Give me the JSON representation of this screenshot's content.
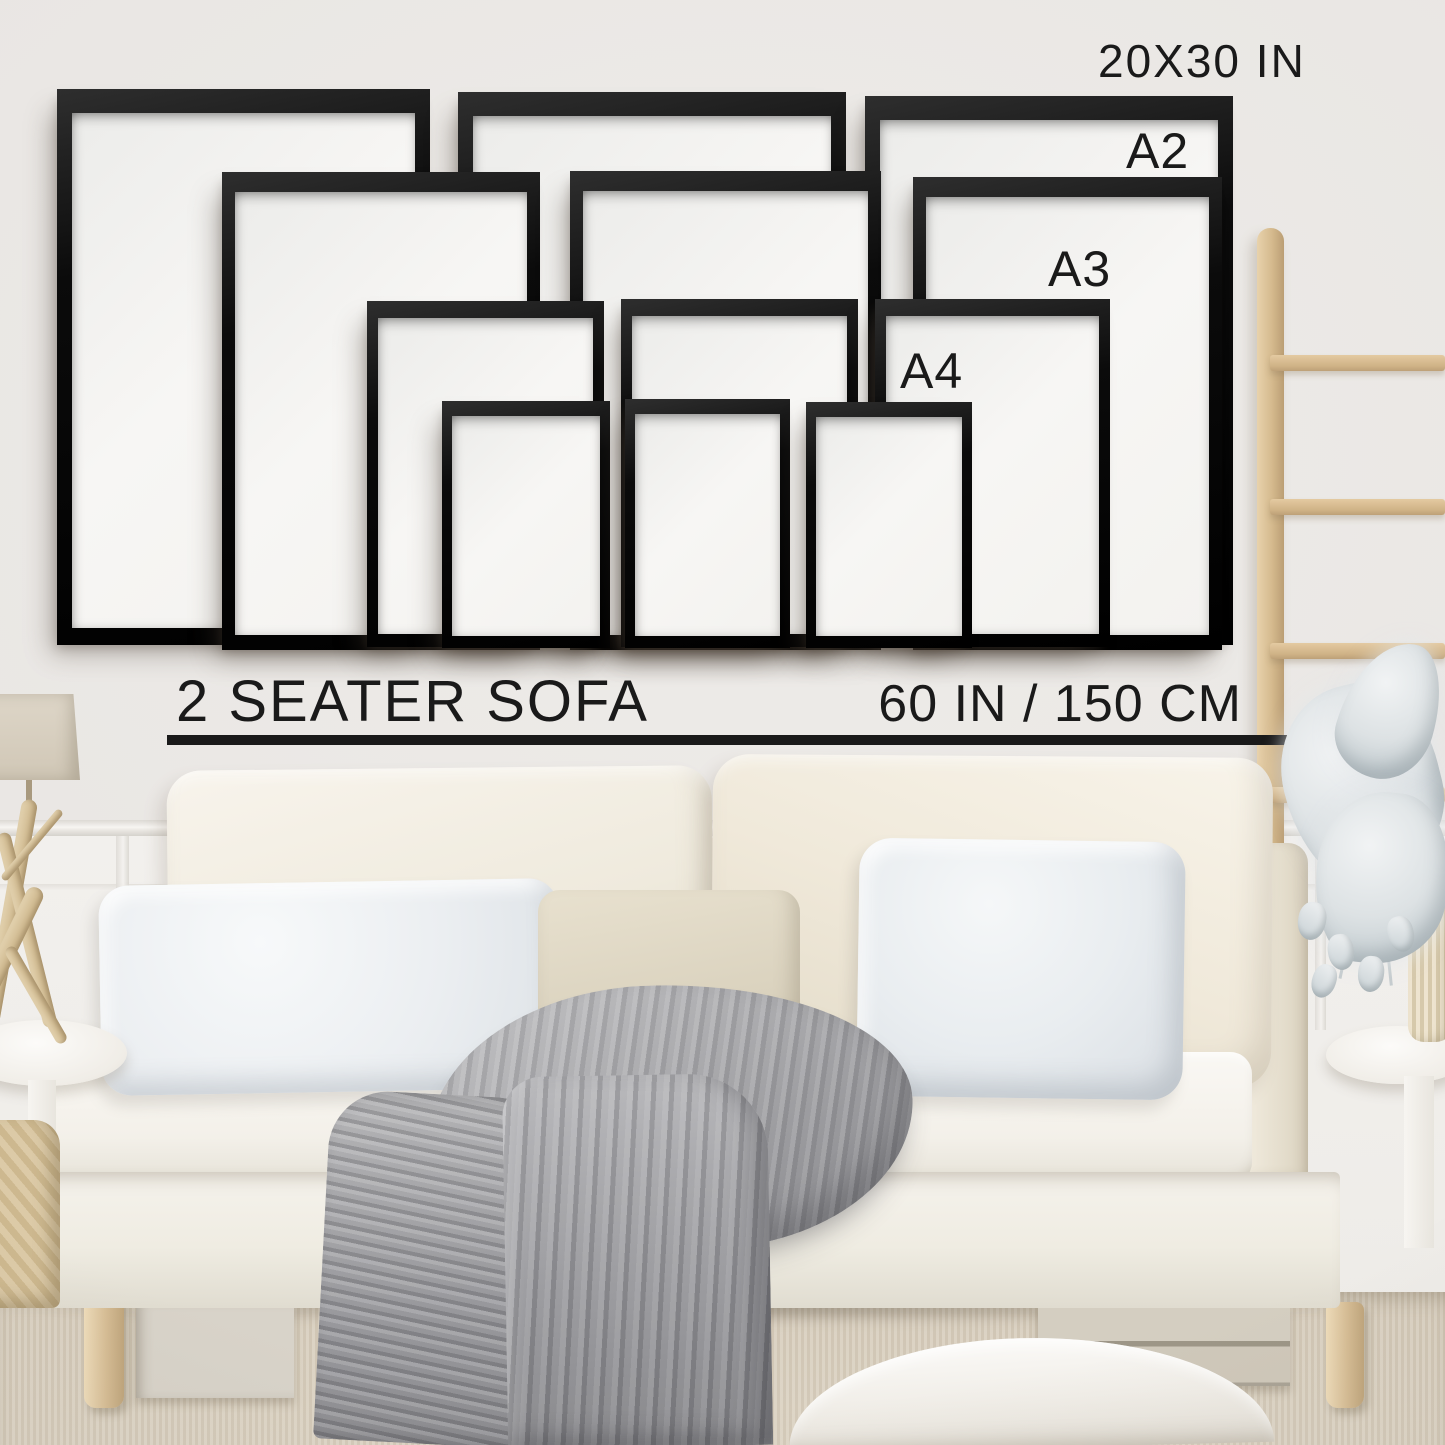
{
  "labels": [
    {
      "id": "label-size-20x30",
      "text": "20X30 IN",
      "x": 1098,
      "y": 34,
      "fs": 46,
      "ls": 2
    },
    {
      "id": "label-size-a2",
      "text": "A2",
      "x": 1126,
      "y": 122,
      "fs": 50,
      "ls": 1
    },
    {
      "id": "label-size-a3",
      "text": "A3",
      "x": 1048,
      "y": 240,
      "fs": 50,
      "ls": 1
    },
    {
      "id": "label-size-a4",
      "text": "A4",
      "x": 900,
      "y": 342,
      "fs": 50,
      "ls": 1
    },
    {
      "id": "label-sofa-type",
      "text": "2 SEATER SOFA",
      "x": 176,
      "y": 668,
      "fs": 58,
      "ls": 2
    },
    {
      "id": "label-sofa-width",
      "text": "60 IN / 150 CM",
      "y": 674,
      "fs": 52,
      "ls": 1,
      "align": "right",
      "right": 203
    }
  ],
  "underline": {
    "x": 167,
    "y": 735,
    "w": 1126,
    "h": 10
  },
  "frames": [
    {
      "name": "frame-20x30-left",
      "size": "20x30",
      "x": 57,
      "y": 89,
      "w": 373,
      "h": 556
    },
    {
      "name": "frame-20x30-middle",
      "size": "20x30",
      "x": 458,
      "y": 92,
      "w": 388,
      "h": 553
    },
    {
      "name": "frame-20x30-right",
      "size": "20x30",
      "x": 865,
      "y": 96,
      "w": 368,
      "h": 549
    },
    {
      "name": "frame-a2-left",
      "size": "a2",
      "x": 222,
      "y": 172,
      "w": 318,
      "h": 478
    },
    {
      "name": "frame-a2-middle",
      "size": "a2",
      "x": 570,
      "y": 171,
      "w": 311,
      "h": 479
    },
    {
      "name": "frame-a2-right",
      "size": "a2",
      "x": 913,
      "y": 177,
      "w": 309,
      "h": 473
    },
    {
      "name": "frame-a3-left",
      "size": "a3",
      "x": 367,
      "y": 301,
      "w": 237,
      "h": 346
    },
    {
      "name": "frame-a3-middle",
      "size": "a3",
      "x": 621,
      "y": 299,
      "w": 237,
      "h": 348
    },
    {
      "name": "frame-a3-right",
      "size": "a3",
      "x": 875,
      "y": 299,
      "w": 235,
      "h": 348
    },
    {
      "name": "frame-a4-left",
      "size": "a4",
      "x": 442,
      "y": 401,
      "w": 168,
      "h": 247
    },
    {
      "name": "frame-a4-middle",
      "size": "a4",
      "x": 625,
      "y": 399,
      "w": 165,
      "h": 249
    },
    {
      "name": "frame-a4-right",
      "size": "a4",
      "x": 806,
      "y": 402,
      "w": 166,
      "h": 246
    }
  ],
  "colors": {
    "text": "#1a1a1a",
    "frame": "#0e0e0e",
    "wall": "#e9e6e3",
    "wood": "#d3b88e",
    "throw": "#a4a4a7",
    "carpet": "#d9cfbf",
    "sofa": "#f5f2ea"
  }
}
